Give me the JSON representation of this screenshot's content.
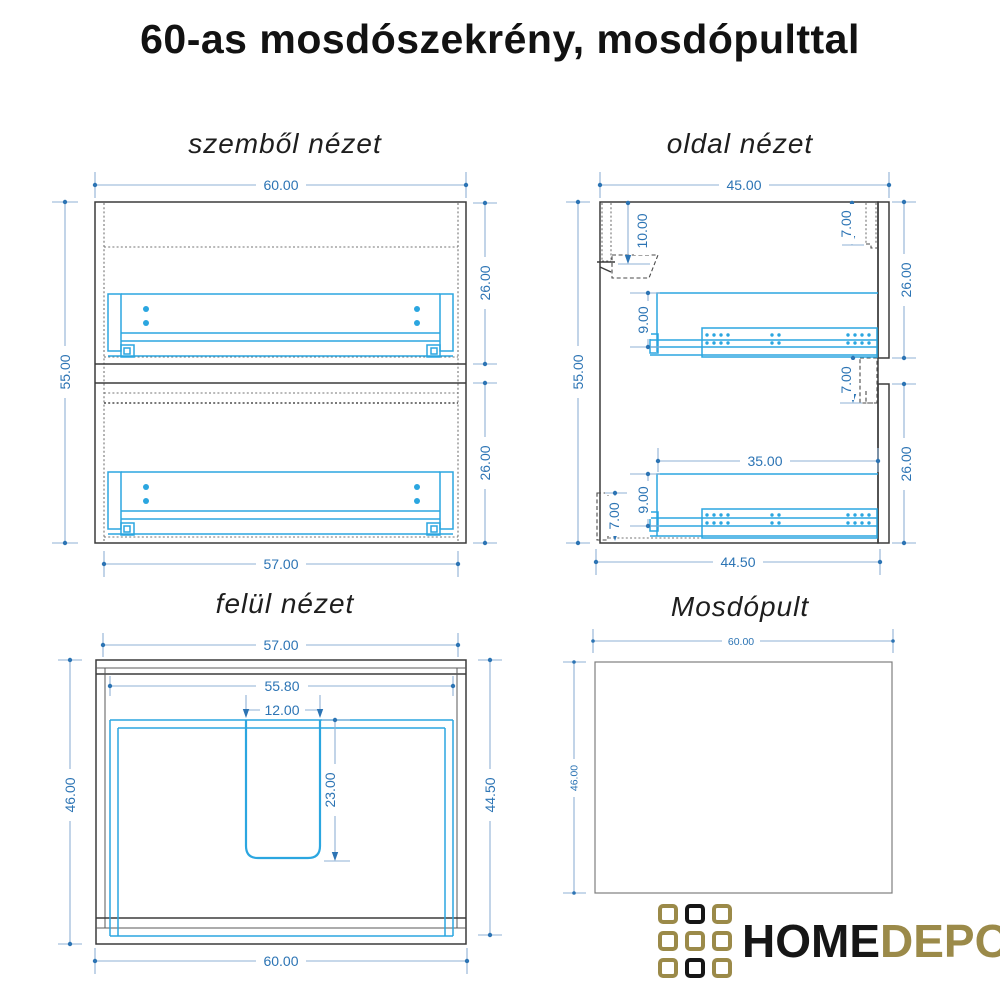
{
  "page": {
    "title": "60-as mosdószekrény, mosdópulttal"
  },
  "views": {
    "front": {
      "title": "szemből nézet",
      "dims": {
        "width_top": "60.00",
        "height_left": "55.00",
        "drawer_top_height": "26.00",
        "drawer_bottom_height": "26.00",
        "width_bottom": "57.00"
      }
    },
    "side": {
      "title": "oldal nézet",
      "dims": {
        "depth_top": "45.00",
        "rail_drop": "10.00",
        "front_top_offset": "7.00",
        "height_left": "55.00",
        "drawer_top_height": "26.00",
        "box_top_height": "9.00",
        "front_gap": "7.00",
        "drawer_bottom_height": "26.00",
        "slide_length": "35.00",
        "box_bottom_height": "9.00",
        "plinth_height": "7.00",
        "depth_bottom": "44.50"
      }
    },
    "top": {
      "title": "felül nézet",
      "dims": {
        "width_top": "57.00",
        "width_inner": "55.80",
        "channel_width": "12.00",
        "depth_left": "46.00",
        "channel_depth": "23.00",
        "depth_right": "44.50",
        "width_bottom": "60.00"
      }
    },
    "counter": {
      "title": "Mosdópult",
      "dims": {
        "width_top": "60.00",
        "depth_left": "46.00"
      }
    }
  },
  "logo": {
    "home": "HOME",
    "depo": "DEPO",
    "grid": [
      "gold",
      "black",
      "gold",
      "gold",
      "gold",
      "gold",
      "gold",
      "black",
      "gold"
    ]
  },
  "colors": {
    "dimension_text": "#2c74b4",
    "dimension_line": "#8fb1d4",
    "drawing_accent_blue": "#2ba6e0",
    "outline_dark": "#3b3b3b",
    "counter_outline": "#7e7e7e",
    "logo_gold": "#9b8a49",
    "logo_black": "#161616"
  }
}
